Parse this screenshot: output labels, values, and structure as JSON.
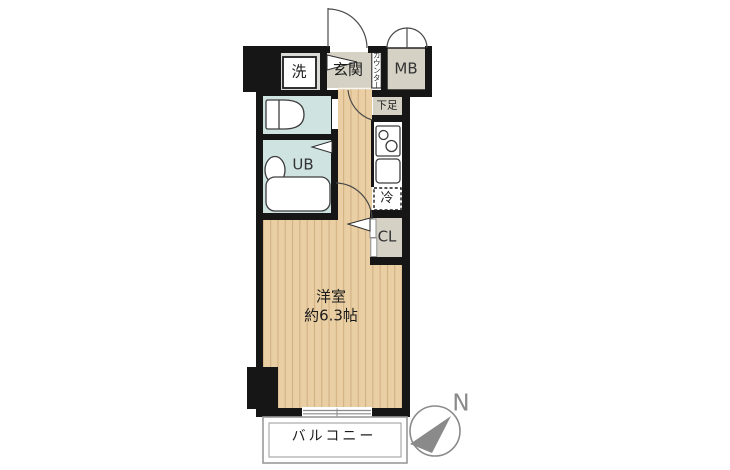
{
  "labels": {
    "laundry": "洗",
    "entrance": "玄関",
    "counter": "カウンター",
    "meter_box": "MB",
    "shoe_cabinet": "下足",
    "unit_bath": "UB",
    "refrigerator": "冷",
    "closet": "CL",
    "room_name": "洋室",
    "room_size": "約6.3帖",
    "balcony": "バルコニー",
    "compass_north": "N"
  },
  "colors": {
    "wall": "#161616",
    "wood_floor": "#e9cfa3",
    "wood_stripe": "#d2b184",
    "wet_area": "#cfe3e1",
    "service_area": "#d5d1c4",
    "laundry_pan": "#dbdbd8",
    "fixture_line": "#3d3d3d",
    "compass": "#8a8a8a",
    "balcony_line": "#9a9a9a"
  }
}
